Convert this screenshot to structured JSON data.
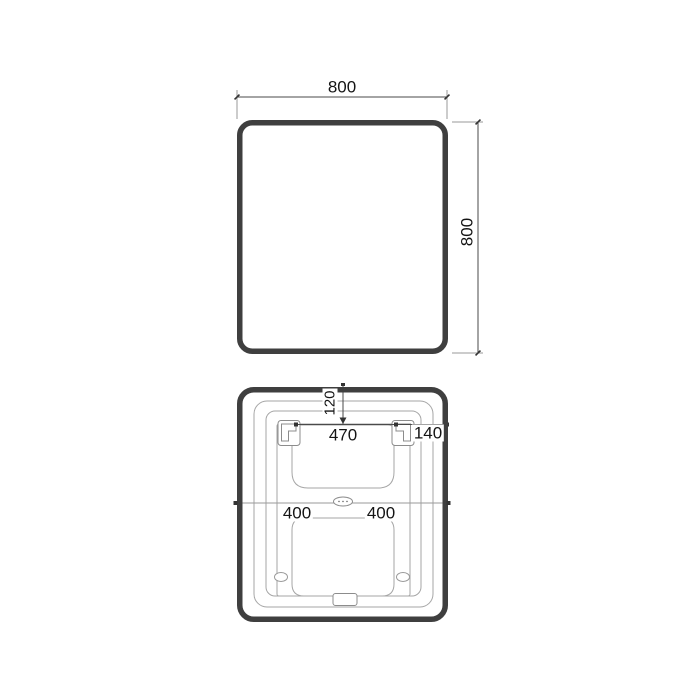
{
  "drawing": {
    "title": "mirror-dimension-drawing",
    "front_view": {
      "width_label": "800",
      "height_label": "800"
    },
    "back_view": {
      "top_offset_label": "120",
      "bracket_span_label": "470",
      "bracket_to_edge_label": "140",
      "center_left_label": "400",
      "center_right_label": "400"
    }
  },
  "colors": {
    "background": "#ffffff",
    "frame_outline": "#3f3f3f",
    "thin_line": "#a6a6a6",
    "dimension_line": "#4a4a4a",
    "text": "#141414"
  }
}
